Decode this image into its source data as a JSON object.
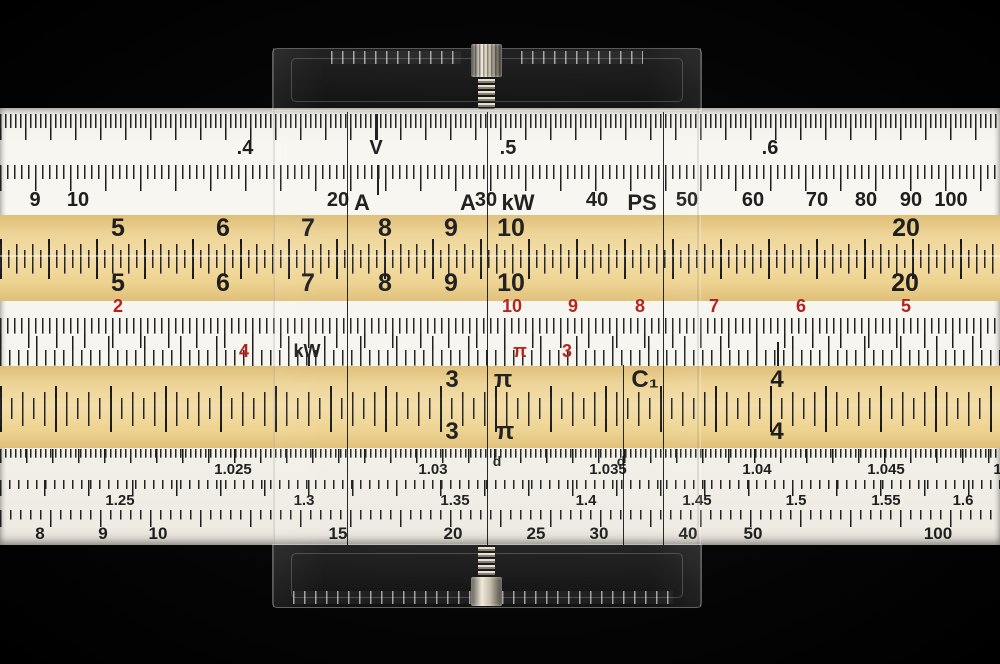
{
  "object": "slide rule with transparent multi-line cursor",
  "colors": {
    "background": "#000000",
    "body_white": "#f7f5ef",
    "band_tan": "#eed391",
    "red_numerals": "#b3231c",
    "ink": "#1e1e1e"
  },
  "scales": {
    "mantissa_row": {
      "labels": [
        {
          "t": ".4",
          "x": 245
        },
        {
          "t": "V",
          "x": 376
        },
        {
          "t": ".5",
          "x": 508
        },
        {
          "t": ".6",
          "x": 770
        }
      ]
    },
    "power_row": {
      "labels": [
        {
          "t": "9",
          "x": 35
        },
        {
          "t": "10",
          "x": 78
        },
        {
          "t": "20",
          "x": 338
        },
        {
          "t": "30",
          "x": 486
        },
        {
          "t": "40",
          "x": 597
        },
        {
          "t": "50",
          "x": 687
        },
        {
          "t": "60",
          "x": 753
        },
        {
          "t": "70",
          "x": 817
        },
        {
          "t": "80",
          "x": 866
        },
        {
          "t": "90",
          "x": 911
        },
        {
          "t": "100",
          "x": 951
        }
      ]
    },
    "unit_marks_row": {
      "labels": [
        {
          "t": "A",
          "x": 362
        },
        {
          "t": "A",
          "x": 468
        },
        {
          "t": "kW",
          "x": 518
        },
        {
          "t": "PS",
          "x": 642
        }
      ]
    },
    "square_scale_upper": {
      "labels": [
        {
          "t": "5",
          "x": 118
        },
        {
          "t": "6",
          "x": 223
        },
        {
          "t": "7",
          "x": 308
        },
        {
          "t": "8",
          "x": 385
        },
        {
          "t": "9",
          "x": 451
        },
        {
          "t": "10",
          "x": 511
        },
        {
          "t": "20",
          "x": 906
        }
      ]
    },
    "square_scale_lower": {
      "labels": [
        {
          "t": "5",
          "x": 118
        },
        {
          "t": "6",
          "x": 223
        },
        {
          "t": "7",
          "x": 308
        },
        {
          "t": "8",
          "x": 385
        },
        {
          "t": "9",
          "x": 451
        },
        {
          "t": "10",
          "x": 511
        },
        {
          "t": "20",
          "x": 905
        }
      ]
    },
    "reciprocal_red_row": {
      "labels": [
        {
          "t": "2",
          "x": 118,
          "c": "red"
        },
        {
          "t": "10",
          "x": 512,
          "c": "red"
        },
        {
          "t": "9",
          "x": 573,
          "c": "red"
        },
        {
          "t": "8",
          "x": 640,
          "c": "red"
        },
        {
          "t": "7",
          "x": 714,
          "c": "red"
        },
        {
          "t": "6",
          "x": 801,
          "c": "red"
        },
        {
          "t": "5",
          "x": 906,
          "c": "red"
        }
      ]
    },
    "mid_gauge_marks": {
      "labels": [
        {
          "t": "4",
          "x": 244,
          "c": "red"
        },
        {
          "t": "kW",
          "x": 307
        },
        {
          "t": "π",
          "x": 520,
          "c": "red"
        },
        {
          "t": "3",
          "x": 567,
          "c": "red"
        }
      ]
    },
    "main_scale_upper": {
      "labels": [
        {
          "t": "3",
          "x": 452
        },
        {
          "t": "π",
          "x": 503
        },
        {
          "t": "C₁",
          "x": 645
        },
        {
          "t": "4",
          "x": 777
        }
      ]
    },
    "main_scale_lower": {
      "labels": [
        {
          "t": "3",
          "x": 452
        },
        {
          "t": "π",
          "x": 505
        },
        {
          "t": "4",
          "x": 777
        }
      ]
    },
    "log_log_1": {
      "labels": [
        {
          "t": "1.025",
          "x": 233
        },
        {
          "t": "1.03",
          "x": 433
        },
        {
          "t": "1.035",
          "x": 608
        },
        {
          "t": "1.04",
          "x": 757
        },
        {
          "t": "1.045",
          "x": 886
        },
        {
          "t": "1.05",
          "x": 1008
        }
      ]
    },
    "log_log_2": {
      "labels": [
        {
          "t": "1.25",
          "x": 120
        },
        {
          "t": "1.3",
          "x": 304
        },
        {
          "t": "1.35",
          "x": 455
        },
        {
          "t": "1.4",
          "x": 586
        },
        {
          "t": "1.45",
          "x": 697
        },
        {
          "t": "1.5",
          "x": 796
        },
        {
          "t": "1.55",
          "x": 886
        },
        {
          "t": "1.6",
          "x": 963
        }
      ]
    },
    "bottom_row": {
      "labels": [
        {
          "t": "8",
          "x": 40
        },
        {
          "t": "9",
          "x": 103
        },
        {
          "t": "10",
          "x": 158
        },
        {
          "t": "15",
          "x": 338
        },
        {
          "t": "20",
          "x": 453
        },
        {
          "t": "25",
          "x": 536
        },
        {
          "t": "30",
          "x": 599
        },
        {
          "t": "40",
          "x": 688
        },
        {
          "t": "50",
          "x": 753
        },
        {
          "t": "100",
          "x": 938
        }
      ]
    }
  },
  "cursor": {
    "hairline_left_x": 347,
    "hairline_center_x": 487,
    "hairline_right_x": 663,
    "hairline_short_x": 623,
    "d_marks": {
      "labels": [
        {
          "t": "d",
          "x": 497
        },
        {
          "t": "d",
          "x": 621
        }
      ]
    }
  }
}
